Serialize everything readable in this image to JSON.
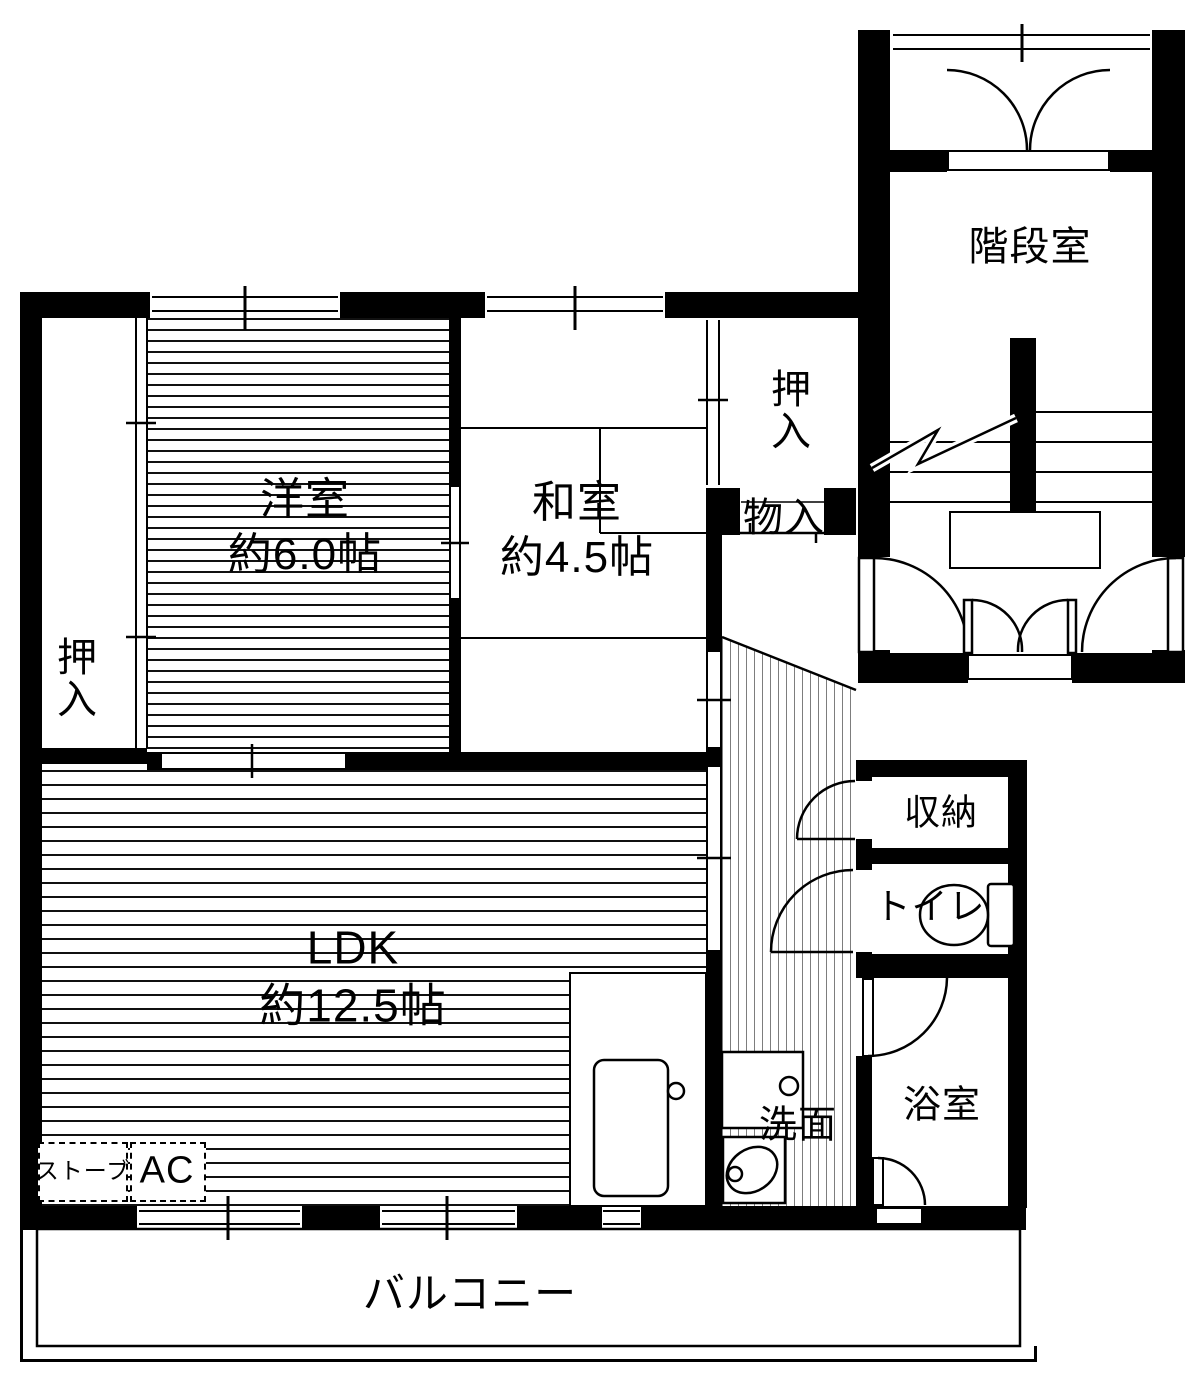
{
  "title": "apartment-floorplan",
  "rooms": {
    "western": {
      "name": "洋室",
      "size": "約6.0帖"
    },
    "japanese": {
      "name": "和室",
      "size": "約4.5帖"
    },
    "ldk": {
      "name": "LDK",
      "size": "約12.5帖"
    },
    "closet_left": {
      "name": "押入"
    },
    "closet_mid": {
      "name": "押入"
    },
    "storage_small": {
      "name": "物入"
    },
    "stairwell": {
      "name": "階段室"
    },
    "storage": {
      "name": "収納"
    },
    "toilet": {
      "name": "トイレ"
    },
    "bath": {
      "name": "浴室"
    },
    "washroom": {
      "name": "洗面"
    },
    "balcony": {
      "name": "バルコニー"
    }
  },
  "equipment": {
    "stove": "ストーブ",
    "ac": "AC"
  },
  "colors": {
    "wall": "#000000",
    "background": "#ffffff",
    "hall_stripe": "#7d7d7d"
  }
}
